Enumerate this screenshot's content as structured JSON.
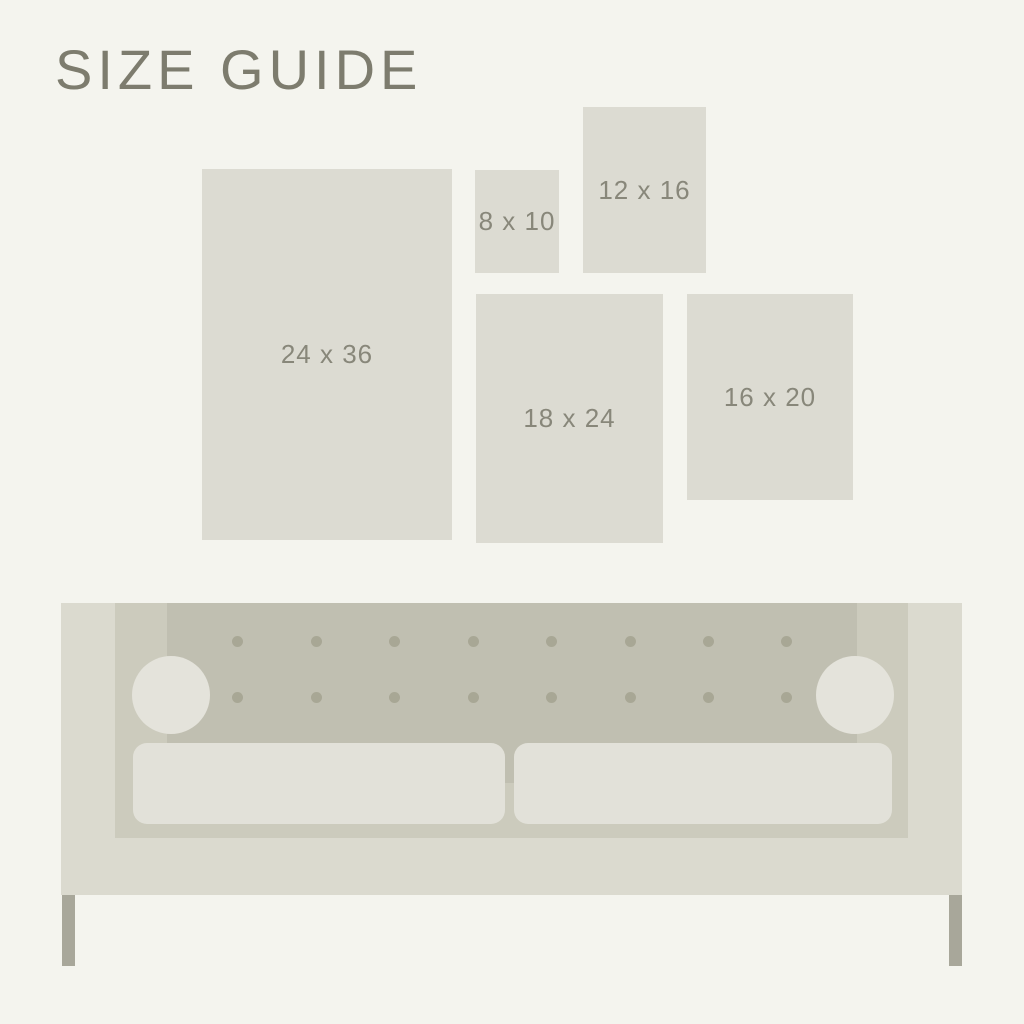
{
  "page": {
    "background_color": "#f4f4ee",
    "title": "SIZE GUIDE",
    "title_color": "#7d7c6e"
  },
  "size_guide": {
    "rect_color": "#dcdbd2",
    "label_color": "#88877a",
    "sizes": [
      {
        "name": "24x36",
        "label": "24 x 36",
        "x": 202,
        "y": 169,
        "w": 250,
        "h": 371
      },
      {
        "name": "8x10",
        "label": "8 x 10",
        "x": 475,
        "y": 170,
        "w": 84,
        "h": 103
      },
      {
        "name": "12x16",
        "label": "12 x 16",
        "x": 583,
        "y": 107,
        "w": 123,
        "h": 166
      },
      {
        "name": "18x24",
        "label": "18 x 24",
        "x": 476,
        "y": 294,
        "w": 187,
        "h": 249
      },
      {
        "name": "16x20",
        "label": "16 x 20",
        "x": 687,
        "y": 294,
        "w": 166,
        "h": 206
      }
    ]
  },
  "sofa": {
    "body_color": "#dbdacf",
    "base_color": "#cccbbd",
    "back_color": "#c0bfb1",
    "cushion_color": "#e2e1d9",
    "bolster_color": "#e4e3db",
    "button_color": "#a8a795",
    "leg_color": "#a8a79a",
    "geometry": {
      "body": {
        "x": 61,
        "y": 603,
        "w": 901,
        "h": 292
      },
      "base": {
        "x": 115,
        "y": 603,
        "w": 793,
        "h": 235
      },
      "back": {
        "x": 167,
        "y": 603,
        "w": 690,
        "h": 180
      },
      "buttons": {
        "rows_y": [
          641,
          697
        ],
        "cols_x": [
          237,
          316,
          394,
          473,
          551,
          630,
          708,
          786
        ],
        "r": 5.5
      },
      "bolsters": [
        {
          "cx": 171,
          "cy": 695,
          "r": 39
        },
        {
          "cx": 855,
          "cy": 695,
          "r": 39
        }
      ],
      "cushions": [
        {
          "x": 133,
          "y": 743,
          "w": 372,
          "h": 81,
          "radius": 14
        },
        {
          "x": 514,
          "y": 743,
          "w": 378,
          "h": 81,
          "radius": 14
        }
      ],
      "legs": [
        {
          "x": 62,
          "y": 895,
          "w": 13,
          "h": 71
        },
        {
          "x": 949,
          "y": 895,
          "w": 13,
          "h": 71
        }
      ]
    }
  }
}
